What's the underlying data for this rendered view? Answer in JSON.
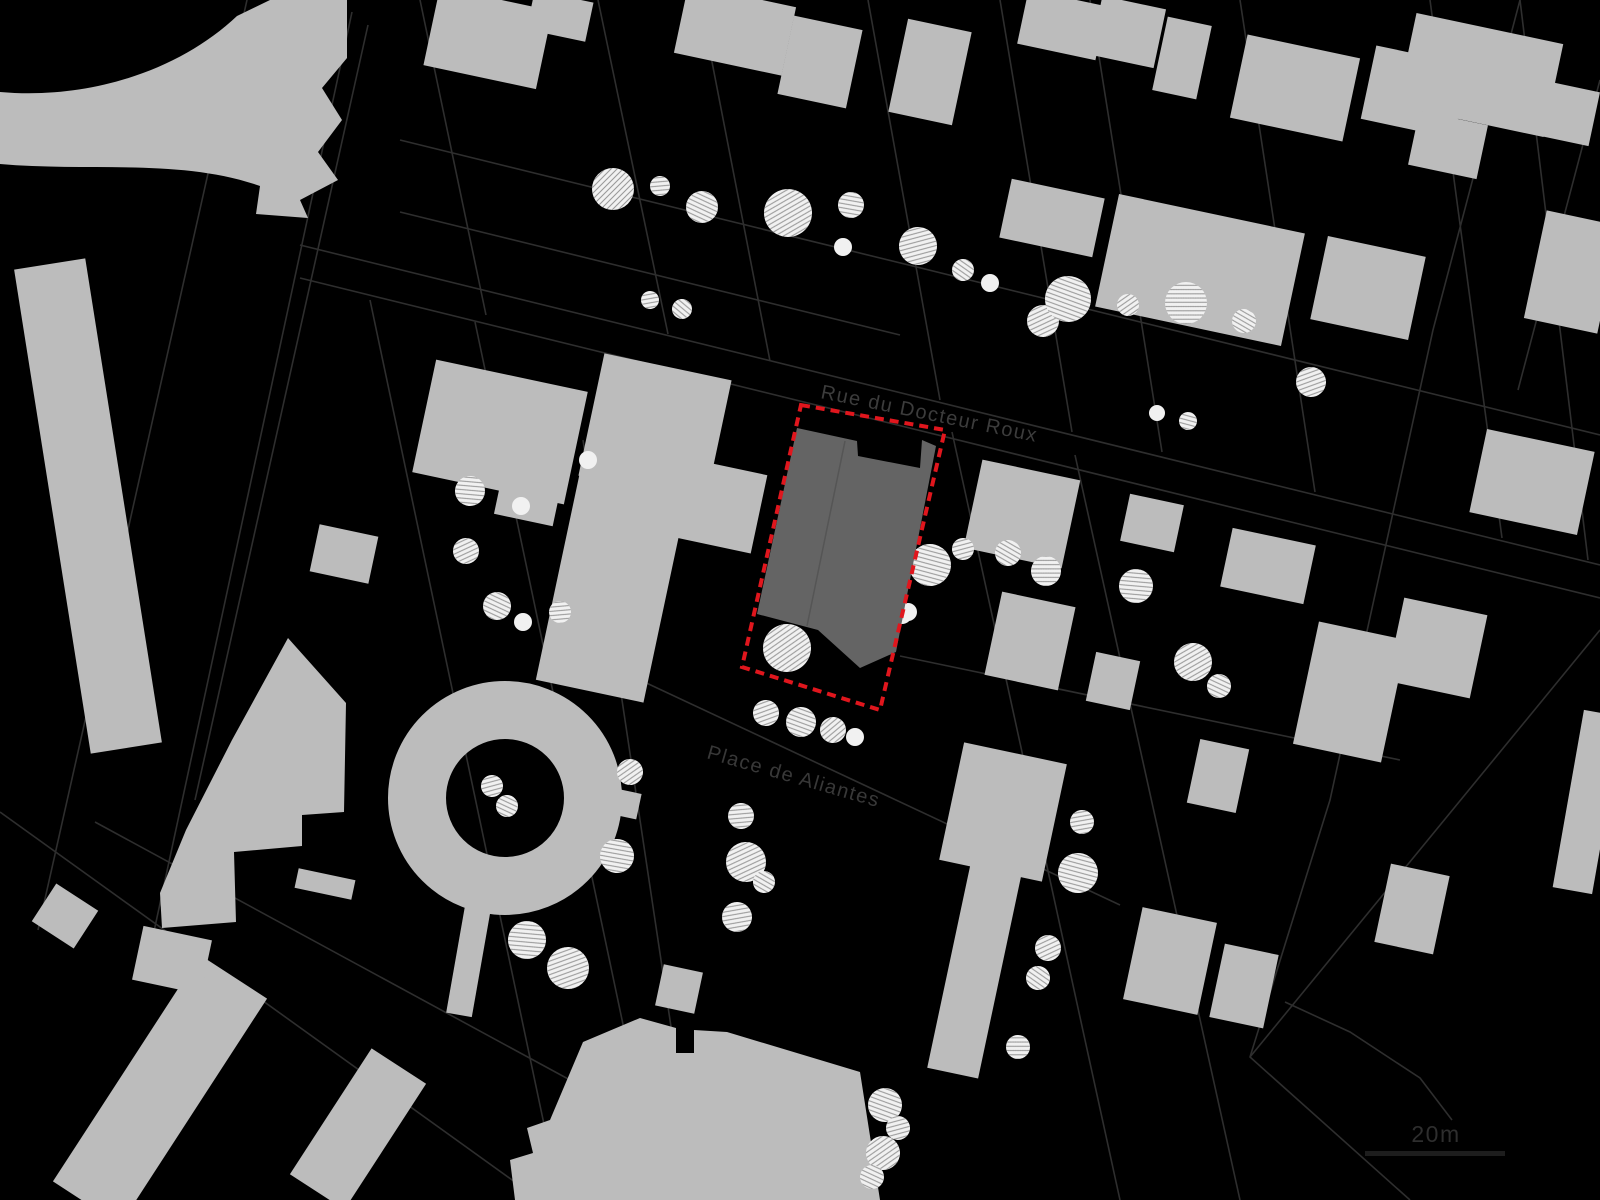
{
  "title": "Figure-ground site plan",
  "labels": {
    "street_name": "Rue du Docteur Roux",
    "place_name": "Place de Aliantes",
    "scale_label": "20m"
  },
  "colors": {
    "background": "#000000",
    "building_fill": "#bcbcbc",
    "site_fill": "#646464",
    "site_divider": "#555555",
    "boundary_red": "#e0161d",
    "parcel_line": "#2e2e2e",
    "tree_fill": "#f1f1f1",
    "tree_hatch": "#9a9a9a",
    "street_label_color": "#3c3c3c",
    "place_label_color": "#383838",
    "scale_text_color": "#2e2e2e",
    "scale_bar_color": "#1d1d1d"
  },
  "map": {
    "width": 1600,
    "height": 1200,
    "street_label": {
      "x": 820,
      "y": 398,
      "angle": 11.5,
      "size": 20
    },
    "place_label": {
      "x": 706,
      "y": 758,
      "angle": 16,
      "size": 20
    },
    "scalebar": {
      "bar_x": 1365,
      "bar_y": 1151,
      "bar_w": 140,
      "bar_h": 5,
      "text_x": 1436,
      "text_y": 1142,
      "size": 23
    },
    "boundary_points": "801,405 945,430 880,710 742,667",
    "site_building_path": "M797,428 L857,441 L858,456 L920,468 L922,440 L936,446 L896,652 L860,668 L818,630 L757,614 Z",
    "site_divider_line": [
      845,
      441,
      807,
      626
    ],
    "street_lines": [
      "300,245 1600,565",
      "300,278 1600,598",
      "400,140 1600,435",
      "400,212 900,335",
      "420,0 486,315",
      "598,0 668,334",
      "700,0 770,361",
      "868,0 940,400",
      "1000,0 1072,432",
      "1090,0 1162,452",
      "1240,0 1315,492",
      "1430,0 1502,538",
      "1520,0 1588,560",
      "370,300 560,1200",
      "475,322 660,1200",
      "583,440 697,1200",
      "952,432 1120,1200",
      "1075,455 1240,1200",
      "640,680 1120,905",
      "900,656 1400,760",
      "1520,0 1433,330 1330,800 1250,1057 1410,1200",
      "1250,1057 1600,630",
      "1600,80 1518,390",
      "247,0 38,930",
      "352,12 150,950",
      "0,812 540,1200",
      "368,25 195,800",
      "95,822 640,1118",
      "1285,1002 1350,1032 1420,1078 1452,1120"
    ],
    "building_rects": [
      [
        488,
        38,
        115,
        80,
        12
      ],
      [
        560,
        16,
        60,
        40,
        12
      ],
      [
        735,
        30,
        110,
        70,
        12
      ],
      [
        820,
        62,
        70,
        80,
        12
      ],
      [
        930,
        72,
        65,
        95,
        12
      ],
      [
        1062,
        25,
        80,
        55,
        12
      ],
      [
        1128,
        32,
        65,
        60,
        12
      ],
      [
        1182,
        58,
        45,
        75,
        12
      ],
      [
        1295,
        88,
        115,
        85,
        12
      ],
      [
        1415,
        92,
        95,
        75,
        12
      ],
      [
        1480,
        75,
        150,
        95,
        12
      ],
      [
        1448,
        145,
        70,
        55,
        12
      ],
      [
        1560,
        112,
        70,
        55,
        12
      ],
      [
        1052,
        218,
        95,
        60,
        12
      ],
      [
        1200,
        270,
        190,
        115,
        12
      ],
      [
        1368,
        288,
        100,
        85,
        12
      ],
      [
        1572,
        272,
        75,
        110,
        12
      ],
      [
        500,
        432,
        155,
        115,
        12
      ],
      [
        655,
        428,
        130,
        125,
        12
      ],
      [
        715,
        505,
        90,
        80,
        12
      ],
      [
        1022,
        514,
        100,
        90,
        12
      ],
      [
        1152,
        523,
        55,
        48,
        12
      ],
      [
        1268,
        566,
        85,
        60,
        12
      ],
      [
        1437,
        648,
        85,
        85,
        12
      ],
      [
        1532,
        482,
        110,
        85,
        12
      ],
      [
        344,
        554,
        60,
        48,
        12
      ],
      [
        528,
        498,
        60,
        45,
        12
      ],
      [
        612,
        586,
        110,
        215,
        12
      ],
      [
        1030,
        641,
        75,
        85,
        12
      ],
      [
        1113,
        681,
        45,
        50,
        12
      ],
      [
        1350,
        692,
        90,
        125,
        12
      ],
      [
        1003,
        812,
        105,
        120,
        12
      ],
      [
        975,
        968,
        52,
        215,
        12
      ],
      [
        679,
        989,
        40,
        42,
        12
      ],
      [
        1218,
        776,
        50,
        65,
        12
      ],
      [
        1170,
        961,
        76,
        94,
        12
      ],
      [
        1244,
        986,
        55,
        75,
        12
      ],
      [
        1412,
        909,
        60,
        80,
        12
      ],
      [
        1588,
        802,
        40,
        180,
        10
      ],
      [
        88,
        506,
        72,
        490,
        -9
      ],
      [
        65,
        916,
        50,
        45,
        33
      ],
      [
        160,
        1090,
        80,
        270,
        33
      ],
      [
        358,
        1129,
        65,
        150,
        33
      ],
      [
        172,
        960,
        70,
        55,
        12
      ],
      [
        205,
        993,
        28,
        30,
        12
      ],
      [
        325,
        884,
        58,
        20,
        12
      ],
      [
        472,
        941,
        26,
        150,
        10
      ],
      [
        612,
        801,
        55,
        26,
        12
      ]
    ],
    "building_paths": [
      "M0,92 C90,100 180,70 237,16 L270,0 L347,0 L347,58 L322,88 L342,120 L318,152 L338,180 L300,200 L308,218 L256,214 L260,186 C180,158 90,172 0,164 Z",
      "M288,638 L346,703 L344,812 L302,815 L302,846 L234,852 L236,922 L162,928 L160,893 L186,830 L232,740 Z",
      "M583,1042 L640,1018 L676,1028 L676,1053 L694,1053 L694,1030 L727,1032 L860,1072 L880,1200 L515,1200 L510,1160 L533,1153 L527,1128 L550,1120 Z"
    ],
    "ring_building": {
      "cx": 505,
      "cy": 798,
      "r": 88,
      "stroke_width": 58
    },
    "trees": [
      [
        613,
        189,
        21,
        1,
        0
      ],
      [
        660,
        186,
        10,
        1,
        40
      ],
      [
        702,
        207,
        16,
        1,
        70
      ],
      [
        788,
        213,
        24,
        1,
        15
      ],
      [
        851,
        205,
        13,
        1,
        55
      ],
      [
        918,
        246,
        19,
        1,
        30
      ],
      [
        843,
        247,
        9,
        0,
        0
      ],
      [
        963,
        270,
        11,
        1,
        80
      ],
      [
        990,
        283,
        9,
        0,
        0
      ],
      [
        1043,
        321,
        16,
        1,
        20
      ],
      [
        1068,
        299,
        23,
        1,
        65
      ],
      [
        1128,
        305,
        11,
        1,
        10
      ],
      [
        1186,
        303,
        21,
        1,
        45
      ],
      [
        1244,
        321,
        12,
        1,
        75
      ],
      [
        1311,
        382,
        15,
        1,
        25
      ],
      [
        1157,
        413,
        8,
        0,
        0
      ],
      [
        1188,
        421,
        9,
        1,
        60
      ],
      [
        650,
        300,
        9,
        1,
        35
      ],
      [
        682,
        309,
        10,
        1,
        85
      ],
      [
        470,
        491,
        15,
        1,
        50
      ],
      [
        521,
        506,
        9,
        0,
        0
      ],
      [
        466,
        551,
        13,
        1,
        20
      ],
      [
        497,
        606,
        14,
        1,
        70
      ],
      [
        523,
        622,
        9,
        0,
        0
      ],
      [
        560,
        612,
        11,
        1,
        40
      ],
      [
        588,
        460,
        9,
        0,
        0
      ],
      [
        787,
        648,
        24,
        1,
        10
      ],
      [
        902,
        614,
        10,
        0,
        0
      ],
      [
        930,
        565,
        21,
        1,
        60
      ],
      [
        963,
        549,
        11,
        1,
        30
      ],
      [
        1008,
        553,
        13,
        1,
        75
      ],
      [
        1046,
        571,
        15,
        1,
        45
      ],
      [
        908,
        612,
        9,
        0,
        0
      ],
      [
        766,
        713,
        13,
        1,
        25
      ],
      [
        801,
        722,
        15,
        1,
        65
      ],
      [
        833,
        730,
        13,
        1,
        5
      ],
      [
        855,
        737,
        9,
        0,
        0
      ],
      [
        1136,
        586,
        17,
        1,
        50
      ],
      [
        1193,
        662,
        19,
        1,
        15
      ],
      [
        1219,
        686,
        12,
        1,
        70
      ],
      [
        1082,
        822,
        12,
        1,
        35
      ],
      [
        1078,
        873,
        20,
        1,
        60
      ],
      [
        1048,
        948,
        13,
        1,
        20
      ],
      [
        1038,
        978,
        12,
        1,
        80
      ],
      [
        1018,
        1047,
        12,
        1,
        45
      ],
      [
        492,
        786,
        11,
        1,
        30
      ],
      [
        507,
        806,
        11,
        1,
        70
      ],
      [
        630,
        772,
        13,
        1,
        10
      ],
      [
        617,
        856,
        17,
        1,
        55
      ],
      [
        741,
        816,
        13,
        1,
        40
      ],
      [
        746,
        862,
        20,
        1,
        20
      ],
      [
        764,
        882,
        11,
        1,
        75
      ],
      [
        737,
        917,
        15,
        1,
        35
      ],
      [
        527,
        940,
        19,
        1,
        50
      ],
      [
        568,
        968,
        21,
        1,
        25
      ],
      [
        885,
        1105,
        17,
        1,
        65
      ],
      [
        898,
        1128,
        12,
        1,
        30
      ],
      [
        883,
        1153,
        17,
        1,
        10
      ],
      [
        872,
        1177,
        12,
        1,
        70
      ]
    ]
  }
}
